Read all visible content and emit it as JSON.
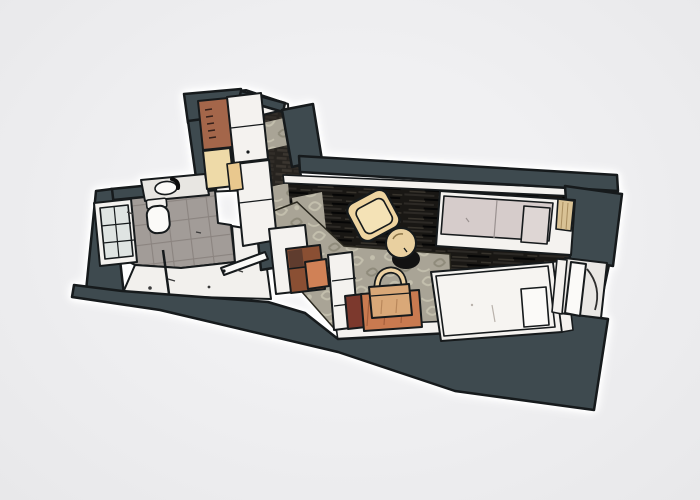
{
  "scene": {
    "description": "Stylized comic-style top-down floor plan illustration of a small hotel studio: bathroom and wardrobe entry on the left, twin-bed room with armchair, side table, luggage bench and desk on the right",
    "background": "#ebebed",
    "rooms": [
      "wardrobe-closet",
      "entry-hall",
      "bathroom",
      "vestibule",
      "twin-bedroom"
    ],
    "furniture": [
      "shower",
      "toilet",
      "sink-counter",
      "wardrobe-cabinet",
      "desk-cabinet",
      "desk-chair",
      "armchair",
      "side-table",
      "luggage-bench",
      "travel-bag",
      "twin-bed-1",
      "twin-bed-2",
      "window-door"
    ]
  },
  "palette": {
    "wall": "#3e4a4f",
    "outline": "#161a1c",
    "halo": "#ffffff",
    "floor_light": "#f2f0ed",
    "frame_white": "#f4f2ef",
    "tile_gray": "#a29c98",
    "tile_line": "#8b8480",
    "wood_base": "#191714",
    "wood_grain_light": "#37332c",
    "wood_grain_mid": "#2c2925",
    "wood_grain_dark": "#060606",
    "brick_base": "#26231f",
    "brick_face": "#3a352f",
    "brick_face2": "#312d28",
    "carpet_base": "#a9a496",
    "carpet_motif_light": "#c3bfad",
    "carpet_motif_dark": "#8f8b7b",
    "glass": "#dfe4e2",
    "sill": "#e9e7e4",
    "duvet_gray": "#d6cccb",
    "pillow_gray": "#ded6d4",
    "bed_white": "#f6f4f1",
    "pillow_white": "#fbfaf8",
    "headboard_tan": "#d9c295",
    "armchair_tan": "#eed4a0",
    "armchair_seat": "#f4e2b6",
    "table_tan": "#e9d0a0",
    "bag_tan": "#d9a878",
    "bag_flap": "#ecd1a2",
    "bench_orange": "#c97a50",
    "chair_orange": "#d08156",
    "maroon": "#7c392d",
    "shelf_brown": "#8a4f33",
    "shelf_brown_dark": "#5f3c2e",
    "wardrobe_brown": "#a4664a",
    "wardrobe_tan_light": "#eedaa8",
    "wardrobe_tan": "#e9c88e",
    "shadow_black": "#121212"
  }
}
